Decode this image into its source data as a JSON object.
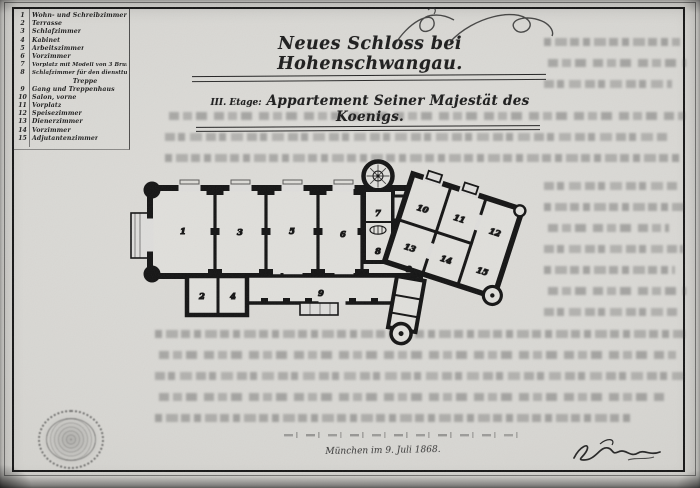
{
  "document": {
    "title_line1": "Neues Schloss bei Hohenschwangau.",
    "title_line2_prefix": "III. Etage:",
    "title_line2": "Appartement Seiner Majestät des Koenigs.",
    "date_line": "München im 9. Juli 1868.",
    "paper_color": "#d7d6d2",
    "ink_color": "#181818"
  },
  "legend": {
    "items": [
      {
        "n": "1",
        "label": "Wohn- und Schreibzimmer"
      },
      {
        "n": "2",
        "label": "Terrasse"
      },
      {
        "n": "3",
        "label": "Schlafzimmer"
      },
      {
        "n": "4",
        "label": "Kabinet"
      },
      {
        "n": "5",
        "label": "Arbeitszimmer"
      },
      {
        "n": "6",
        "label": "Vorzimmer"
      },
      {
        "n": "7",
        "label": "Vorplatz mit Modell von 3 Brunnen"
      },
      {
        "n": "8",
        "label": "Schlafzimmer für den diensttuenden Lakaien"
      },
      {
        "n": "",
        "label": "Treppe"
      },
      {
        "n": "9",
        "label": "Gang und Treppenhaus"
      },
      {
        "n": "10",
        "label": "Salon, vorne"
      },
      {
        "n": "11",
        "label": "Vorplatz"
      },
      {
        "n": "12",
        "label": "Speisezimmer"
      },
      {
        "n": "13",
        "label": "Dienerzimmer"
      },
      {
        "n": "14",
        "label": "Vorzimmer"
      },
      {
        "n": "15",
        "label": "Adjutantenzimmer"
      }
    ]
  },
  "plan": {
    "room_labels": [
      "1",
      "2",
      "3",
      "4",
      "5",
      "6",
      "7",
      "8",
      "9",
      "10",
      "11",
      "12",
      "13",
      "14",
      "15"
    ]
  }
}
